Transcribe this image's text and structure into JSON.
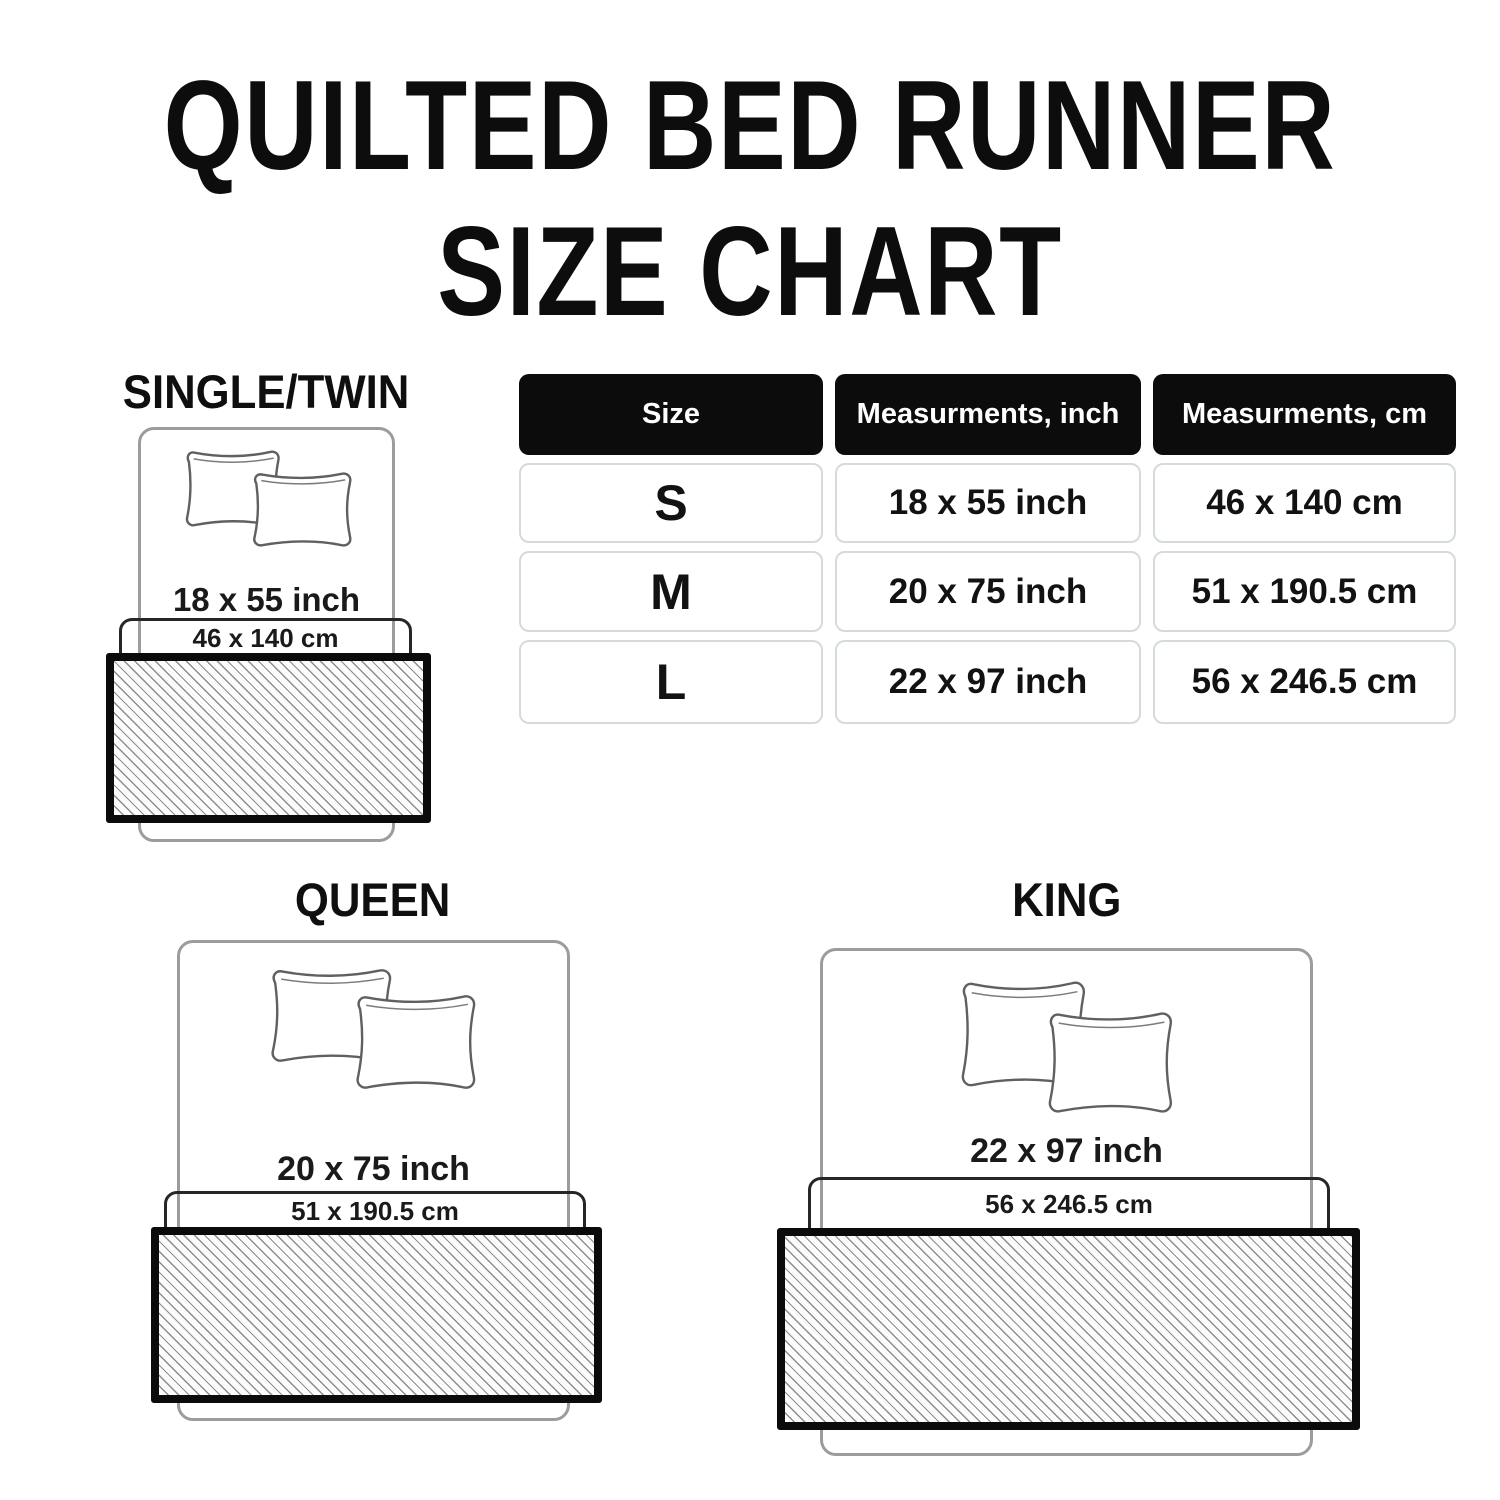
{
  "title": {
    "line1": "QUILTED BED RUNNER",
    "line2": "SIZE CHART"
  },
  "table": {
    "headers": [
      "Size",
      "Measurments, inch",
      "Measurments, cm"
    ],
    "rows": [
      {
        "size": "S",
        "inch": "18 x 55 inch",
        "cm": "46 x 140 cm"
      },
      {
        "size": "M",
        "inch": "20 x 75 inch",
        "cm": "51 x 190.5 cm"
      },
      {
        "size": "L",
        "inch": "22 x 97 inch",
        "cm": "56 x 246.5 cm"
      }
    ]
  },
  "diagrams": [
    {
      "label": "SINGLE/TWIN",
      "inch": "18 x 55 inch",
      "cm": "46 x 140 cm"
    },
    {
      "label": "QUEEN",
      "inch": "20 x 75 inch",
      "cm": "51 x 190.5 cm"
    },
    {
      "label": "KING",
      "inch": "22 x 97 inch",
      "cm": "56 x 246.5 cm"
    }
  ],
  "chart_data": {
    "type": "table",
    "title": "QUILTED BED RUNNER SIZE CHART",
    "columns": [
      "Size",
      "Measurments, inch",
      "Measurments, cm"
    ],
    "rows": [
      [
        "S",
        "18 x 55 inch",
        "46 x 140 cm"
      ],
      [
        "M",
        "20 x 75 inch",
        "51 x 190.5 cm"
      ],
      [
        "L",
        "22 x 97 inch",
        "56 x 246.5 cm"
      ]
    ]
  },
  "colors": {
    "text": "#131313",
    "bed_outline": "#9c9c9c",
    "pillow_outline": "#606060",
    "runner_outline_box": "#262626",
    "runner_border": "#0b0b0b",
    "hatch_line": "#8e8e8e",
    "table_header_bg": "#0c0c0c",
    "table_header_text": "#ffffff",
    "table_cell_border": "#d5dbdd"
  }
}
